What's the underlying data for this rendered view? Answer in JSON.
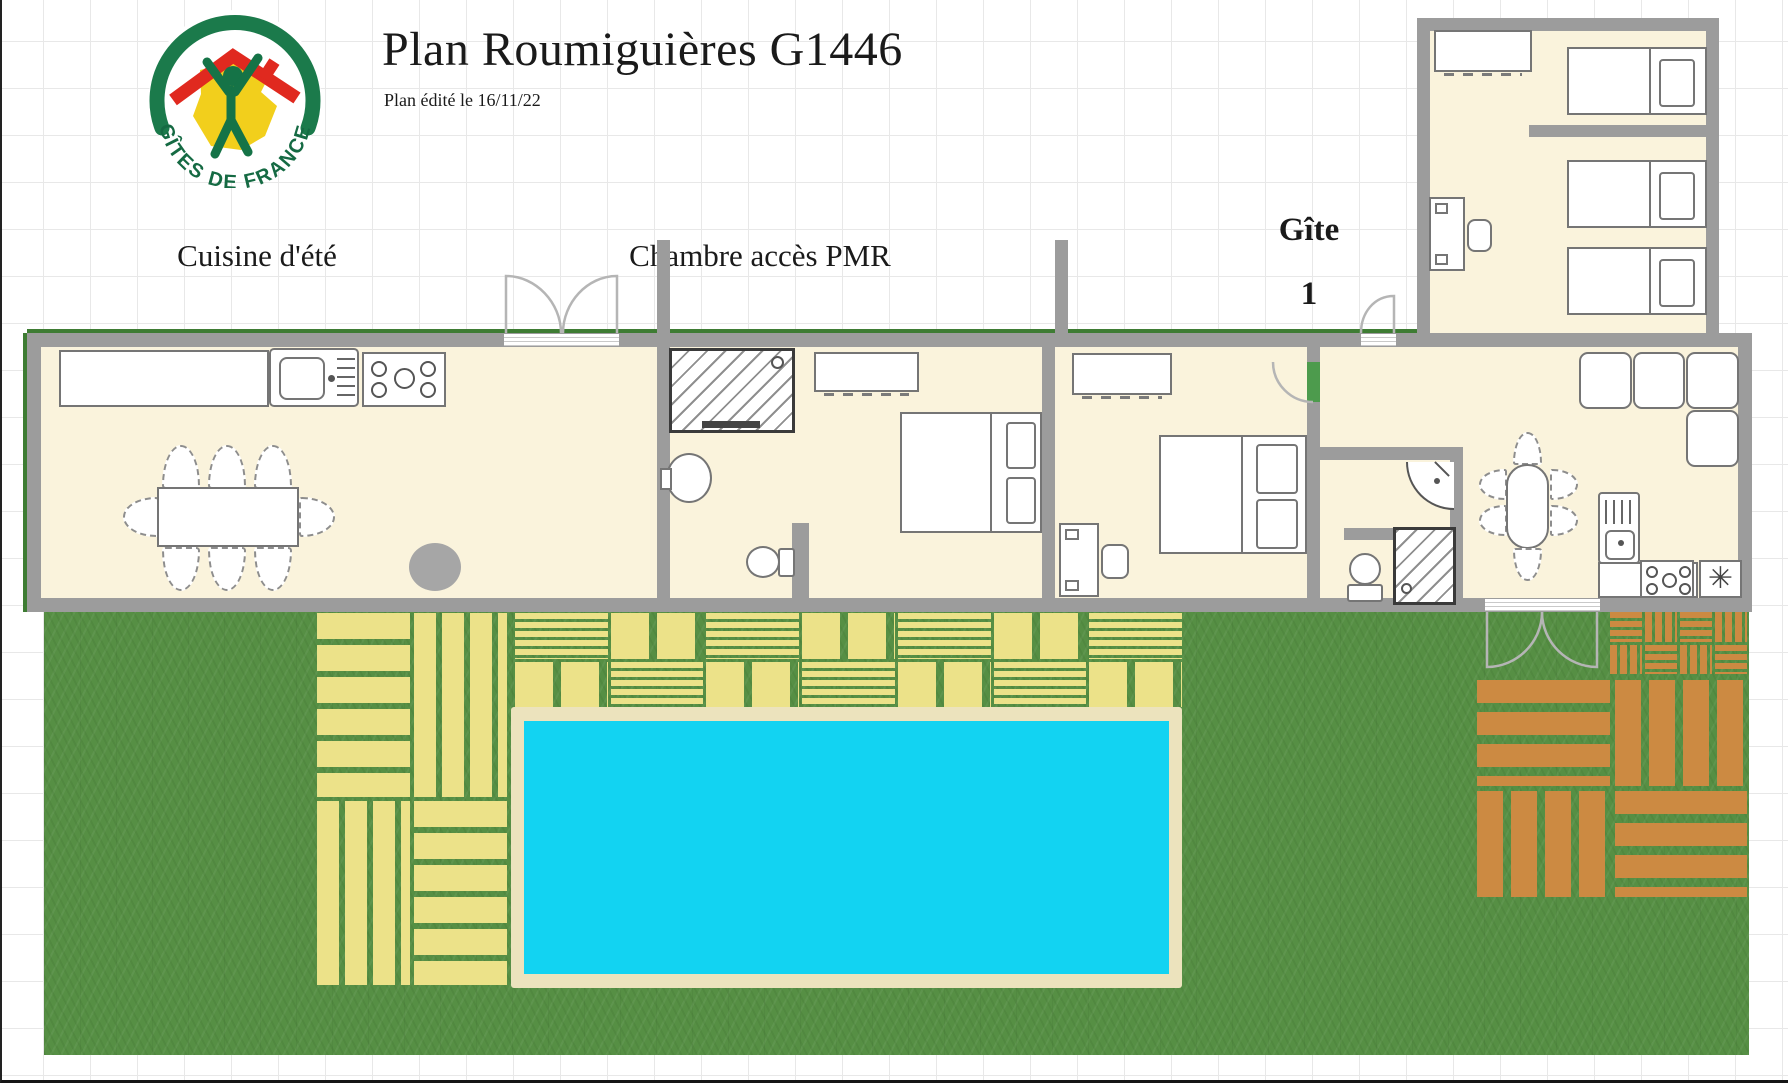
{
  "header": {
    "title": "Plan Roumiguières G1446",
    "subtitle": "Plan édité le 16/11/22"
  },
  "logo": {
    "text": "GÎTES DE FRANCE"
  },
  "labels": {
    "summer_kitchen": "Cuisine d'été",
    "pmr_bedroom": "Chambre accès PMR",
    "gite_line1": "Gîte",
    "gite_line2": "1"
  },
  "icons": {
    "appliance_fan": "✳"
  },
  "colors": {
    "wall": "#9c9c9c",
    "floor": "#faf3dc",
    "grass": "#568f44",
    "deck_yellow": "#ece289",
    "deck_orange": "#cc8a42",
    "pool_water": "#12d3f2",
    "pool_border": "#ece3bd",
    "edging_green": "#3e7c33",
    "grid_line": "#e8e8e8",
    "logo_green": "#156a43",
    "logo_red": "#e0291f",
    "logo_yellow": "#f2cf1c"
  }
}
